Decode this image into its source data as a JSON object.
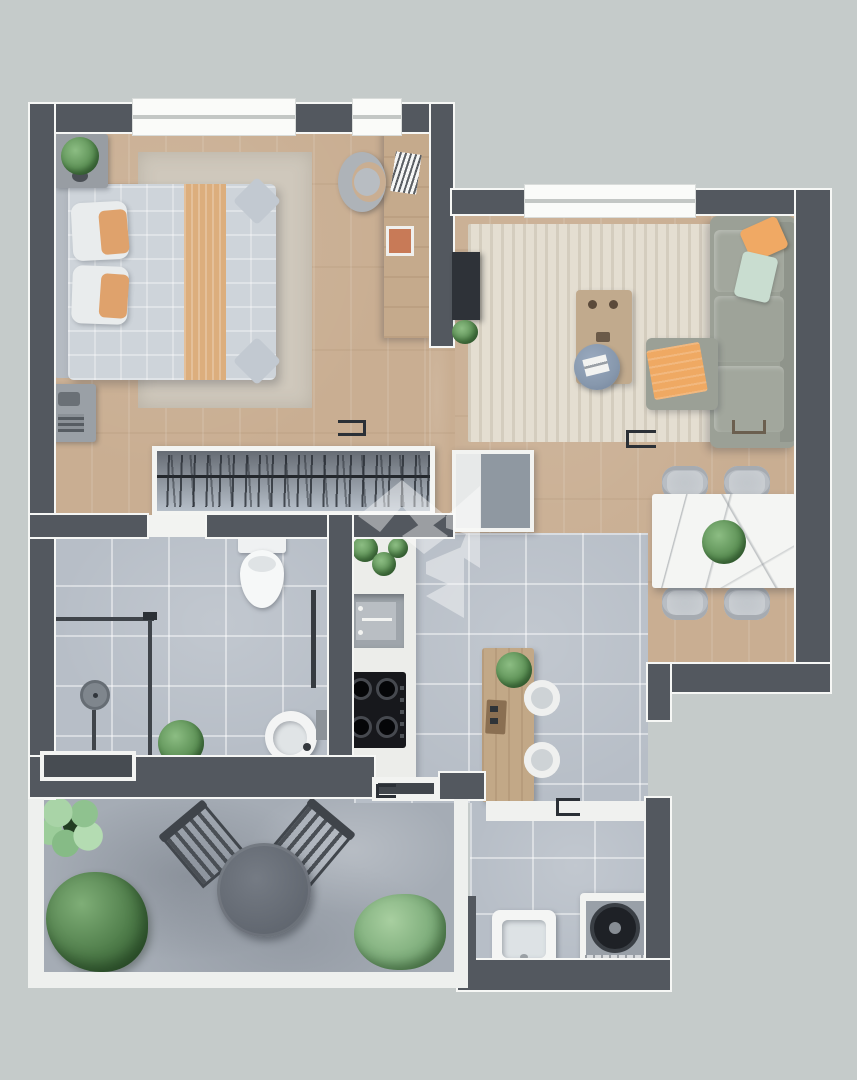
{
  "meta": {
    "title": "Top-down 3D rendered floor plan of a one-bedroom apartment with terrace",
    "type": "floor-plan-render",
    "visible_text": "none"
  },
  "watermark": {
    "name": "geometric-monogram-watermark",
    "style": "translucent white angular logo centered on plan",
    "opacity": 0.42
  },
  "palette": {
    "background": "#c5cbca",
    "wall": "#53585f",
    "wall_edge": "#f6f7f5",
    "wood_floor": "#c9ae92",
    "tile_floor": "#b7bec7",
    "terrace_concrete": "#a5acb5",
    "living_rug": "#e4ded1",
    "bedroom_rug": "#cfc8bc",
    "sofa_gray": "#9ba096",
    "accent_orange": "#efa963",
    "accent_mint": "#c9ddd0",
    "pouf_blue": "#8798ad",
    "bed_linen": "#ced4da",
    "bed_runner": "#dcae7d",
    "furniture_wood": "#c2a887",
    "marble": "#f4f5f3",
    "plant_green": "#5d9156",
    "cooktop_black": "#17181c"
  },
  "rooms": [
    {
      "name": "Bedroom",
      "floor": "wood",
      "items": [
        "double bed with tan runner and orange pillows",
        "area rug",
        "nightstand with potted plant",
        "nightstand with radio",
        "wall desk",
        "curved desk chair",
        "papers on desk",
        "orange desk mat",
        "open wardrobe with hangers",
        "top window",
        "desk window"
      ]
    },
    {
      "name": "Living room",
      "floor": "wood",
      "items": [
        "L-shaped gray sofa",
        "orange cushion",
        "mint cushion",
        "ottoman with orange throw",
        "round blue pouf with magazine",
        "wooden coffee table with two cups",
        "wall-mounted TV",
        "floor plant",
        "cream area rug",
        "top window"
      ]
    },
    {
      "name": "Dining area",
      "floor": "wood",
      "items": [
        "white marble dining table",
        "green centerpiece plant",
        "four upholstered chairs"
      ]
    },
    {
      "name": "Bathroom",
      "floor": "tile",
      "items": [
        "toilet",
        "walk-in shower with glass screen",
        "round rain shower head",
        "round pedestal sink",
        "towel rail",
        "potted plant",
        "wall window box"
      ]
    },
    {
      "name": "Kitchen",
      "floor": "tile",
      "items": [
        "white counter run",
        "gray sink with faucet",
        "black four-burner gas cooktop",
        "tall cabinet fridge unit",
        "shelf plants",
        "wooden island with plant and board",
        "two round bar stools"
      ]
    },
    {
      "name": "Hallway",
      "floor": "wood",
      "items": [
        "sliding door floor brackets"
      ]
    },
    {
      "name": "Terrace",
      "floor": "concrete",
      "items": [
        "round bistro table",
        "two slatted garden chairs",
        "flowering plant",
        "large bush",
        "small bush",
        "white railing",
        "sliding terrace door"
      ]
    },
    {
      "name": "Service area",
      "floor": "tile",
      "items": [
        "laundry basin",
        "AC heat-pump unit with round fan",
        "sliding service door"
      ]
    }
  ]
}
